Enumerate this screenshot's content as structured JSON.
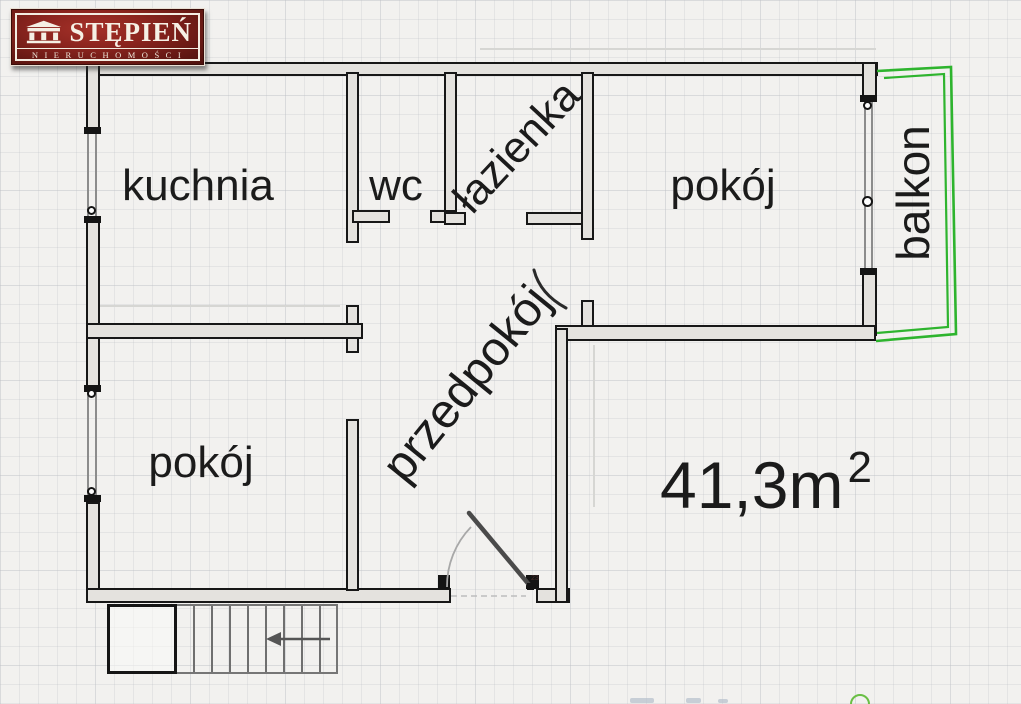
{
  "logo": {
    "brand": "STĘPIEŃ",
    "subtitle": "NIERUCHOMOŚCI",
    "icon": "temple-icon",
    "background_color": "#7c1f1a"
  },
  "plan": {
    "rooms": {
      "kitchen": "kuchnia",
      "wc": "wc",
      "bathroom": "łazienka",
      "room_right": "pokój",
      "hallway": "przedpokój",
      "room_left": "pokój",
      "balcony": "balkon"
    },
    "area": {
      "value": "41,3m",
      "superscript": "2"
    },
    "entrance_door_label": "23",
    "colors": {
      "balcony_outline": "#2eb42e",
      "wall_line": "#171717",
      "wall_fill": "#e4e2de"
    }
  }
}
